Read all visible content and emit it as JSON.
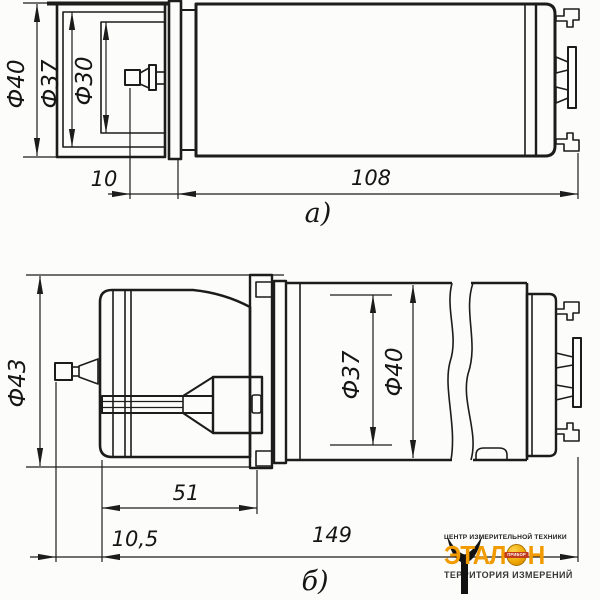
{
  "figure_a": {
    "label": "а)",
    "dia_outer": "Ф40",
    "dia_mid": "Ф37",
    "dia_inner": "Ф30",
    "len_connector": "10",
    "len_body": "108"
  },
  "figure_b": {
    "label": "б)",
    "dia_clamp": "Ф43",
    "dia_mid": "Ф37",
    "dia_outer": "Ф40",
    "len_clamp": "51",
    "len_nose": "10,5",
    "len_total": "149"
  },
  "logo": {
    "tagline_top": "ЦЕНТР ИЗМЕРИТЕЛЬНОЙ ТЕХНИКИ",
    "brand": "ЭТАЛОН",
    "brand_left": "ЭТАЛ",
    "brand_right": "Н",
    "globe_label": "ПРИБОР",
    "tagline_bottom": "ТЕРРИТОРИЯ ИЗМЕРЕНИЙ",
    "colors": {
      "brand_orange": "#F29B00",
      "globe_gold": "#EDA600",
      "banner_red": "#C23A1C",
      "ink": "#1C1C1C"
    }
  }
}
